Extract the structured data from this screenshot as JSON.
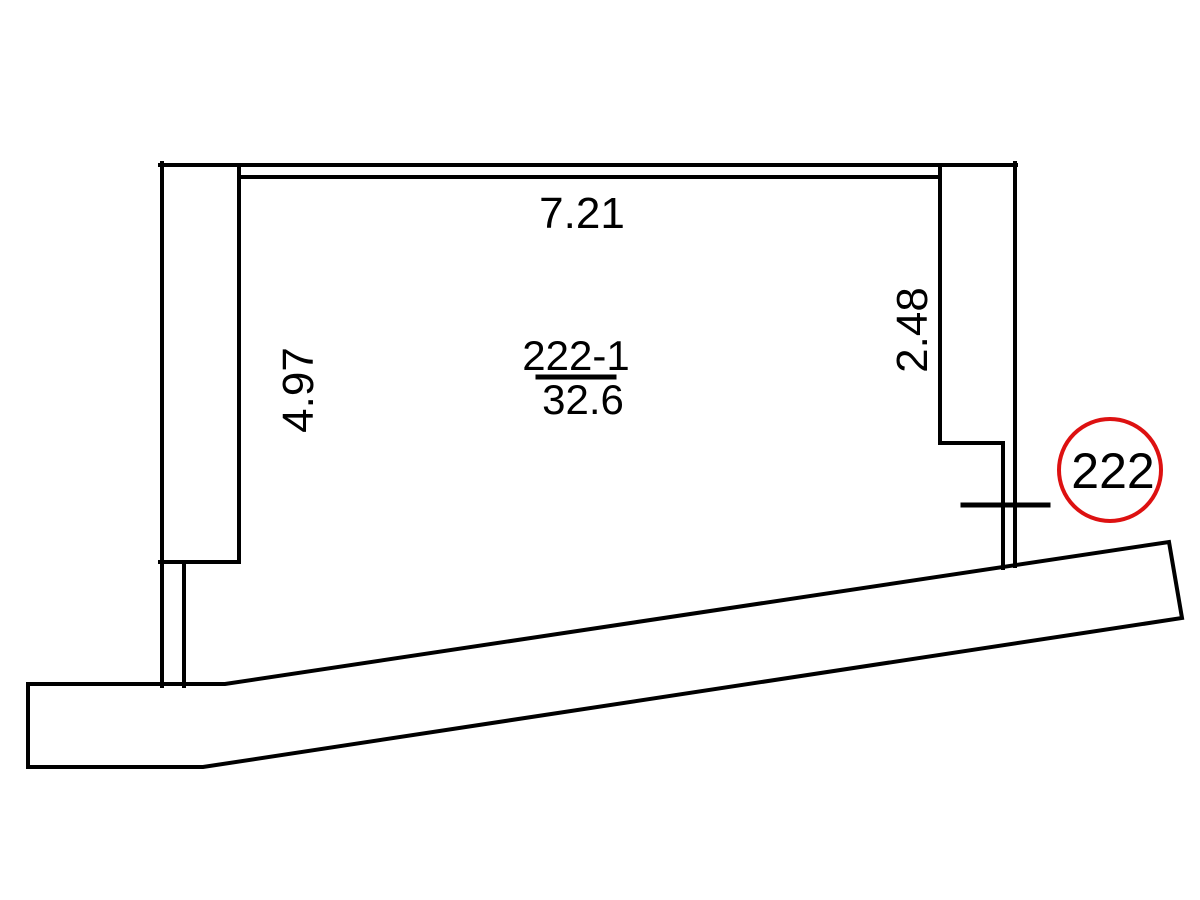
{
  "drawing": {
    "unit_badge": {
      "label": "222"
    },
    "room": {
      "number": "222-1",
      "area": "32.6"
    },
    "dimensions": {
      "top_width": "7.21",
      "left_height": "4.97",
      "right_height": "2.48"
    },
    "colors": {
      "line": "#000000",
      "accent": "#dd1111",
      "background": "#ffffff"
    }
  }
}
